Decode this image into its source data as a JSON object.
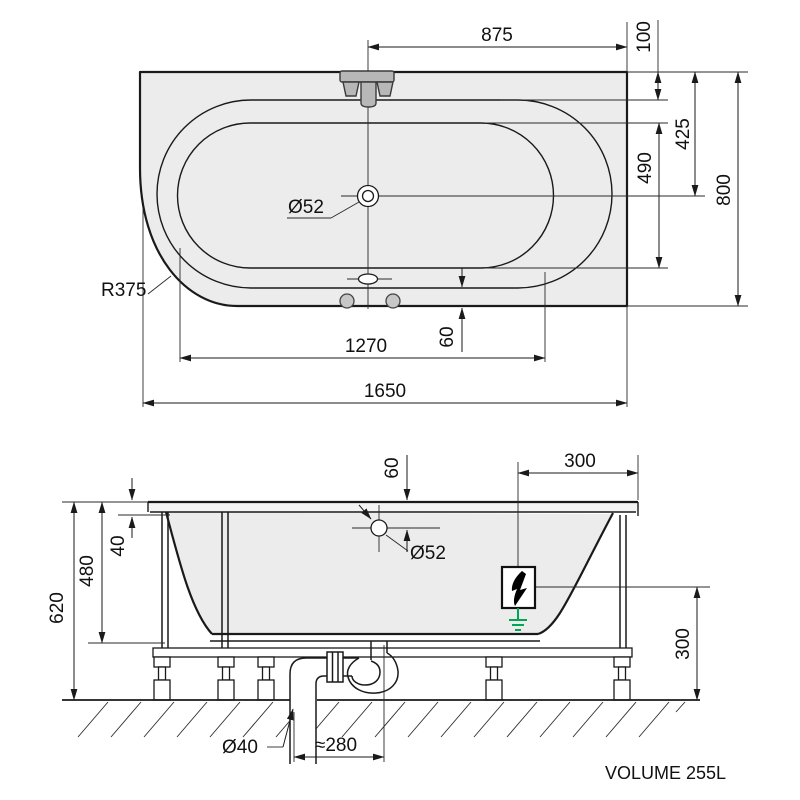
{
  "drawing": {
    "plan": {
      "faucet_to_edge": "875",
      "rim_top_offset": "100",
      "edge_to_drain": "425",
      "basin_width": "490",
      "overall_width": "800",
      "drain_diameter": "Ø52",
      "corner_radius": "R375",
      "rim_bottom_offset": "60",
      "basin_length": "1270",
      "overall_length": "1650"
    },
    "elevation": {
      "deck_to_drain": "60",
      "drain_diameter": "Ø52",
      "box_to_edge": "300",
      "rim_height": "40",
      "inner_depth": "480",
      "total_height": "620",
      "box_to_floor": "300",
      "pipe_diameter": "Ø40",
      "trap_offset": "≈280"
    },
    "volume_label": "VOLUME 255L",
    "colors": {
      "ground_green": "#00a651",
      "fill_gray": "#ececec"
    }
  }
}
